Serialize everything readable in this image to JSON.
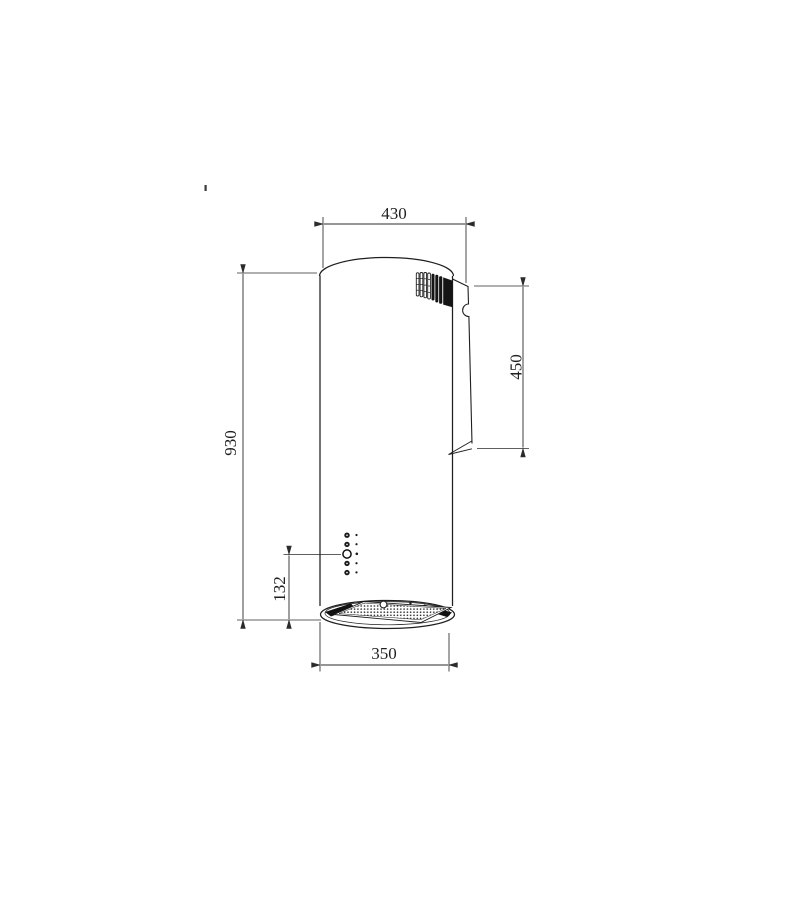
{
  "dimensions": {
    "top_width": "430",
    "overall_height": "930",
    "chimney_height": "450",
    "control_offset": "132",
    "body_diameter": "350"
  },
  "colors": {
    "line": "#1f1f1f",
    "dimension": "#2b2b2b",
    "background": "#ffffff"
  }
}
